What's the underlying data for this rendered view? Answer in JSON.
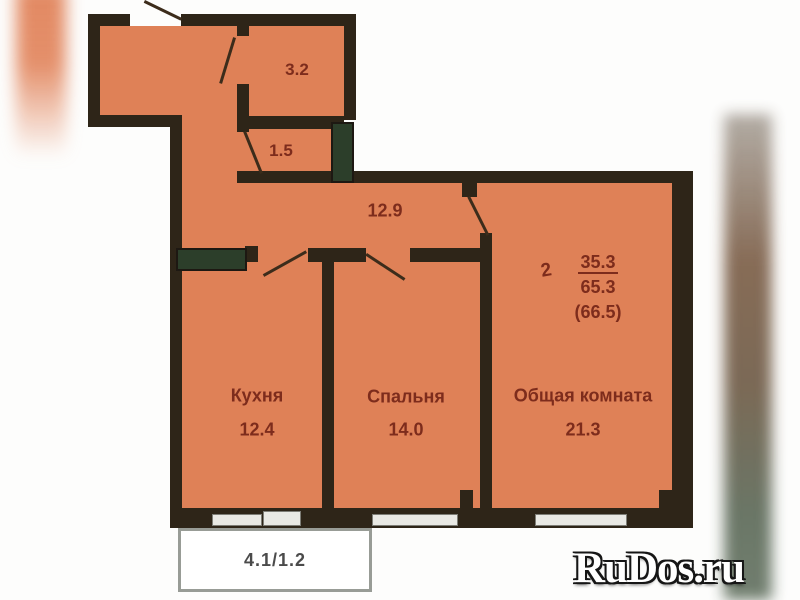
{
  "plan": {
    "areas": {
      "closet": "3.2",
      "bath": "1.5",
      "hallway": "12.9"
    },
    "rooms": [
      {
        "label": "Кухня",
        "area": "12.4"
      },
      {
        "label": "Спальня",
        "area": "14.0"
      },
      {
        "label": "Общая комната",
        "area": "21.3"
      }
    ],
    "summary": {
      "rooms_count": "2",
      "living_area": "35.3",
      "total_area": "65.3",
      "total_with_balcony": "(66.5)"
    },
    "balcony": "4.1/1.2",
    "colors": {
      "room_fill": "#df8157",
      "wall": "#2e2518",
      "wall_green": "#2c3e2a",
      "label_text": "#7d2c1c"
    }
  },
  "watermark": {
    "text": "RuDos.ru"
  }
}
